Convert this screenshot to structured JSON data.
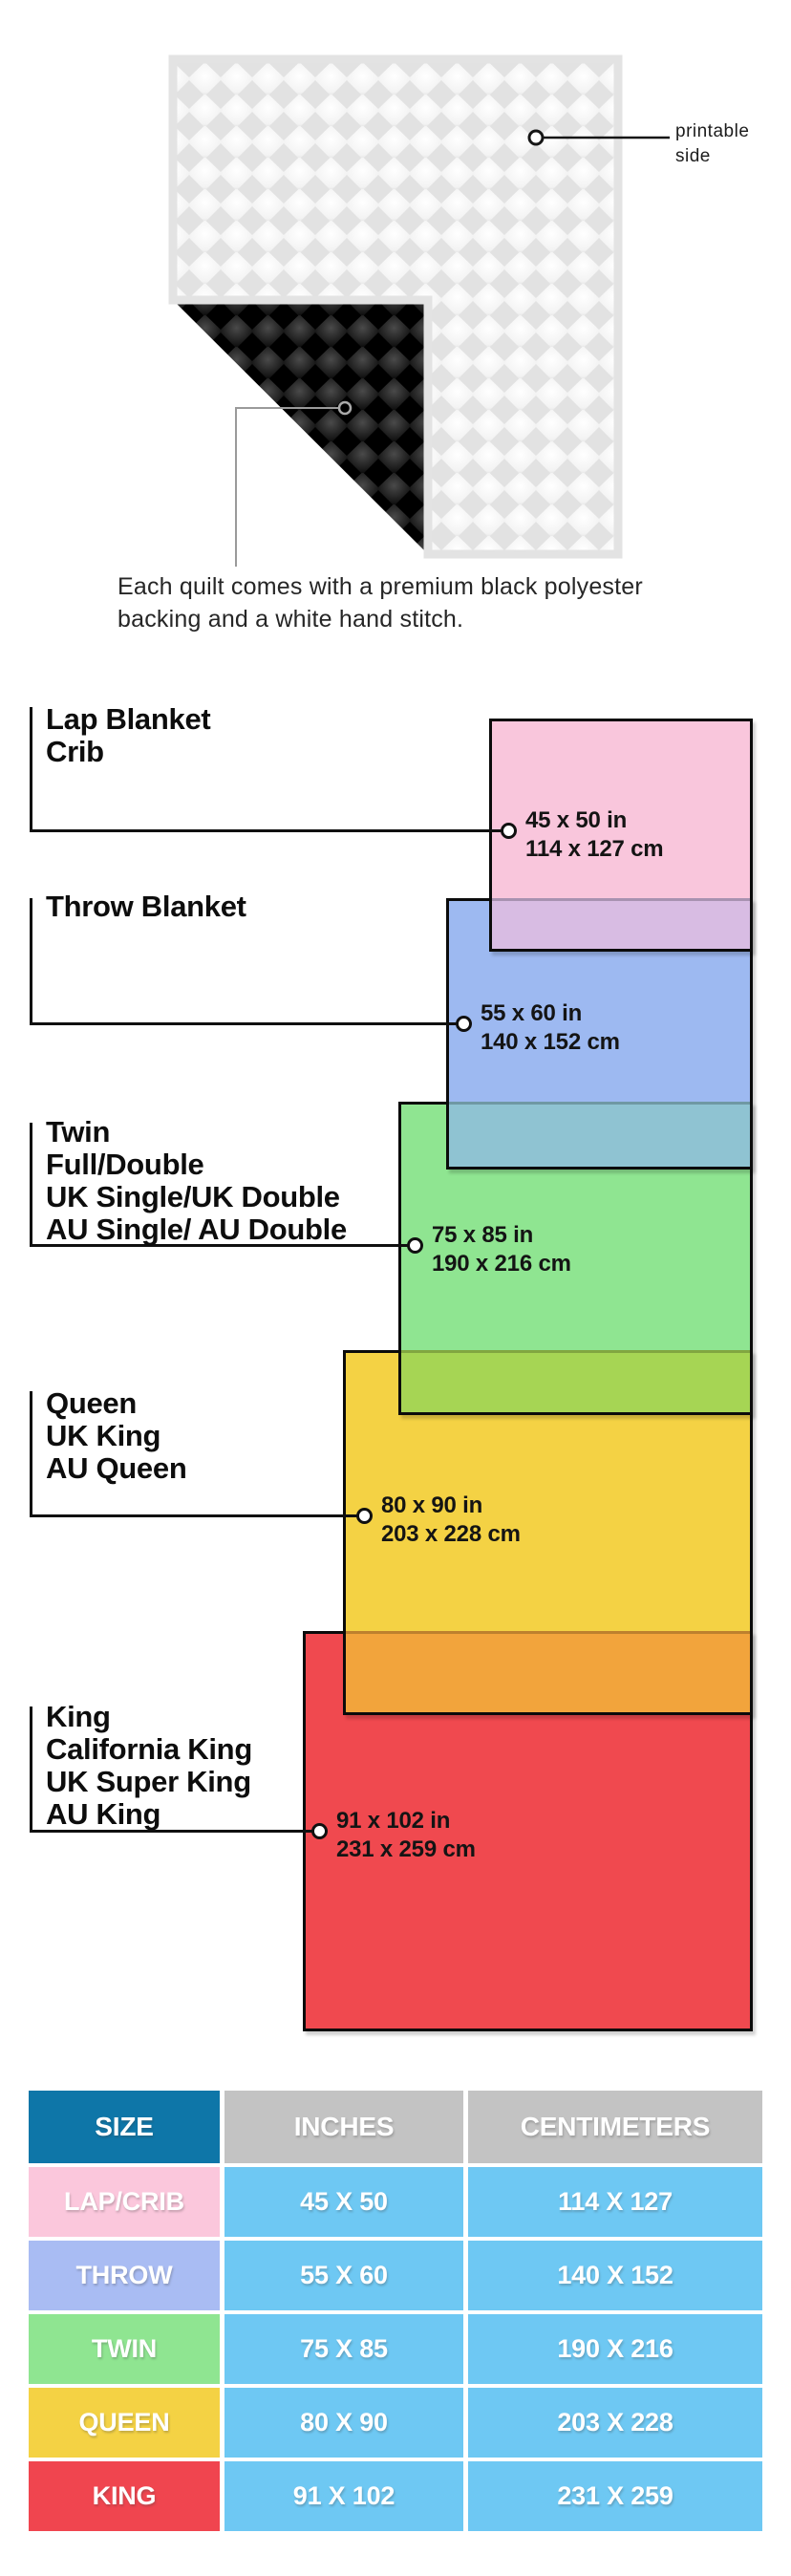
{
  "hero": {
    "printable_label_line1": "printable",
    "printable_label_line2": "side",
    "caption_line1": "Each quilt comes with a premium black polyester",
    "caption_line2": "backing and a white hand stitch."
  },
  "diagram": {
    "items": [
      {
        "names": [
          "Lap Blanket",
          "Crib"
        ],
        "inches": "45 x 50 in",
        "cm": "114 x 127 cm",
        "fill": "#F9C6DC",
        "overlap_fill": "#D8BCE3"
      },
      {
        "names": [
          "Throw Blanket"
        ],
        "inches": "55 x 60 in",
        "cm": "140 x 152 cm",
        "fill": "#9DB9F1",
        "overlap_fill": "#8FC3D2"
      },
      {
        "names": [
          "Twin",
          "Full/Double",
          "UK Single/UK Double",
          "AU Single/ AU Double"
        ],
        "inches": "75 x 85 in",
        "cm": "190 x 216 cm",
        "fill": "#8FE591",
        "overlap_fill": "#A6D554"
      },
      {
        "names": [
          "Queen",
          "UK King",
          "AU Queen"
        ],
        "inches": "80 x 90 in",
        "cm": "203 x 228 cm",
        "fill": "#F4D244",
        "overlap_fill": "#F2A43C"
      },
      {
        "names": [
          "King",
          "California King",
          "UK Super King",
          "AU King"
        ],
        "inches": "91 x 102 in",
        "cm": "231 x 259 cm",
        "fill": "#F0494F"
      }
    ]
  },
  "table": {
    "headers": [
      "SIZE",
      "INCHES",
      "CENTIMETERS"
    ],
    "rows": [
      {
        "size": "LAP/CRIB",
        "inches": "45 X 50",
        "cm": "114 X 127",
        "color": "#FBC7DC"
      },
      {
        "size": "THROW",
        "inches": "55 X 60",
        "cm": "140 X 152",
        "color": "#A9BCF3"
      },
      {
        "size": "TWIN",
        "inches": "75 X 85",
        "cm": "190 X 216",
        "color": "#8FE591"
      },
      {
        "size": "QUEEN",
        "inches": "80 X 90",
        "cm": "203 X 228",
        "color": "#F4D244"
      },
      {
        "size": "KING",
        "inches": "91 X 102",
        "cm": "231 X 259",
        "color": "#F0454F"
      }
    ],
    "colors": {
      "header_size_bg": "#0E76A8",
      "header_metric_bg": "#C3C3C3",
      "value_bg": "#6EC8F3"
    }
  }
}
